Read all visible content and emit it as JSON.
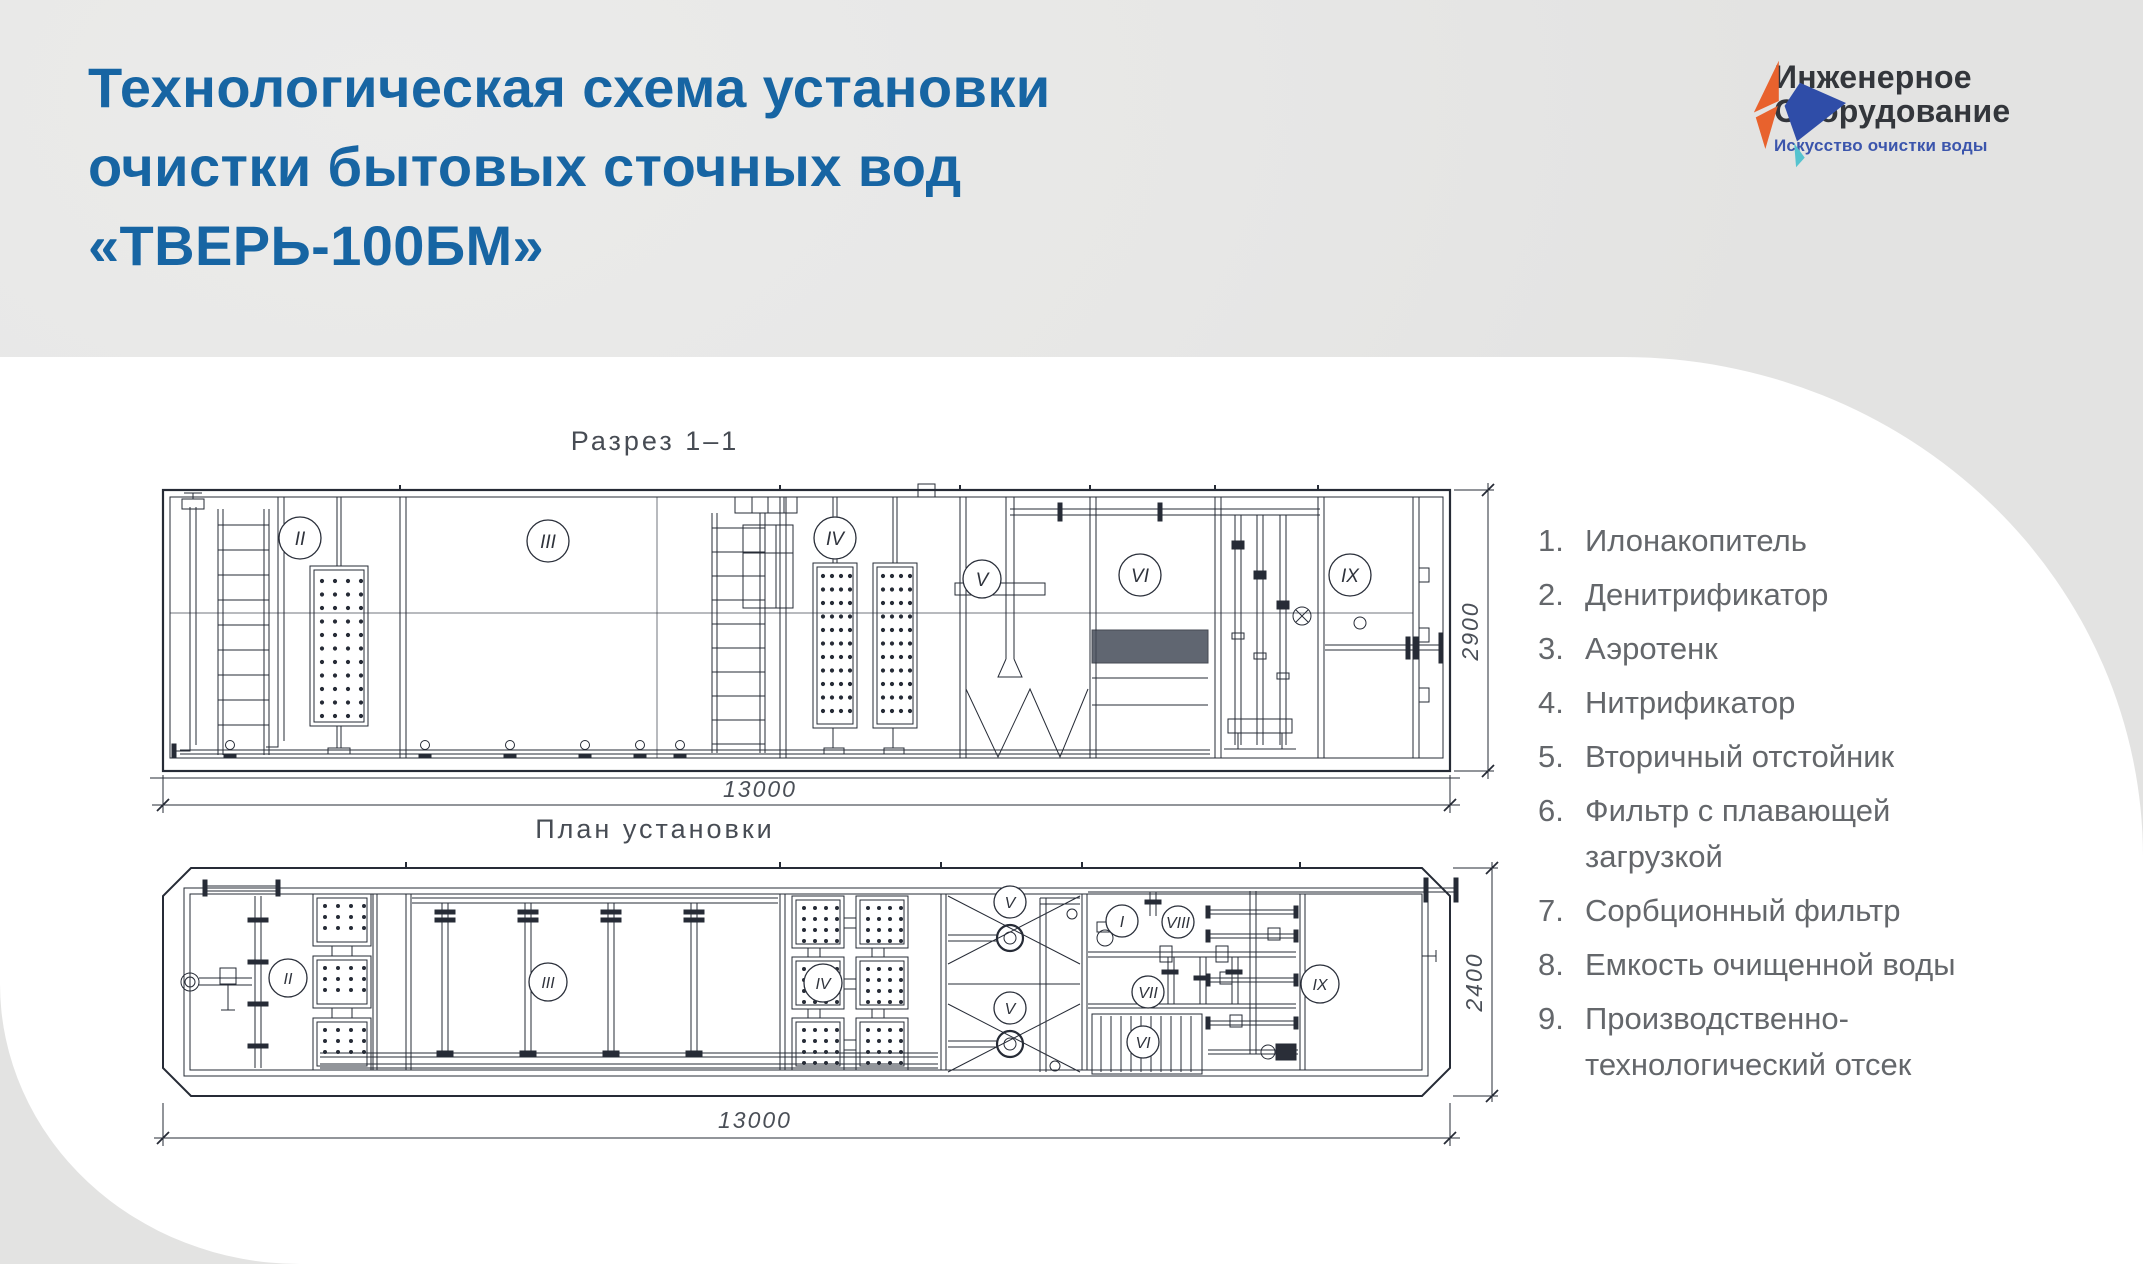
{
  "header": {
    "title_lines": [
      "Технологическая схема установки",
      "очистки бытовых сточных вод",
      "«ТВЕРЬ-100БМ»"
    ]
  },
  "logo": {
    "name_line1": "Инженерное",
    "name_line2": "Оборудование",
    "tagline": "Искусство очистки воды",
    "colors": {
      "orange": "#E8622D",
      "blue": "#2F4DA8",
      "teal": "#55C3CF"
    }
  },
  "section_view": {
    "title": "Разрез 1–1",
    "length_label": "13000",
    "height_label": "2900",
    "compartments": [
      "II",
      "III",
      "IV",
      "V",
      "VI",
      "IX"
    ]
  },
  "plan_view": {
    "title": "План установки",
    "length_label": "13000",
    "width_label": "2400",
    "compartments": [
      "II",
      "III",
      "IV",
      "V",
      "V",
      "I",
      "VIII",
      "VII",
      "VI",
      "IX"
    ]
  },
  "legend": {
    "items": [
      {
        "num": "1.",
        "text": "Илонакопитель"
      },
      {
        "num": "2.",
        "text": "Денитрификатор"
      },
      {
        "num": "3.",
        "text": "Аэротенк"
      },
      {
        "num": "4.",
        "text": "Нитрификатор"
      },
      {
        "num": "5.",
        "text": "Вторичный отстойник"
      },
      {
        "num": "6.",
        "text": "Фильтр с плавающей загрузкой"
      },
      {
        "num": "7.",
        "text": "Сорбционный фильтр"
      },
      {
        "num": "8.",
        "text": "Емкость очищенной воды"
      },
      {
        "num": "9.",
        "text": "Производственно-технологический отсек"
      }
    ]
  },
  "colors": {
    "background": "#e8e8e7",
    "surface": "#ffffff",
    "title_blue": "#1765A3",
    "legend_gray": "#64676b",
    "line_dark": "#262b36",
    "cad_text": "#4a4f57"
  }
}
